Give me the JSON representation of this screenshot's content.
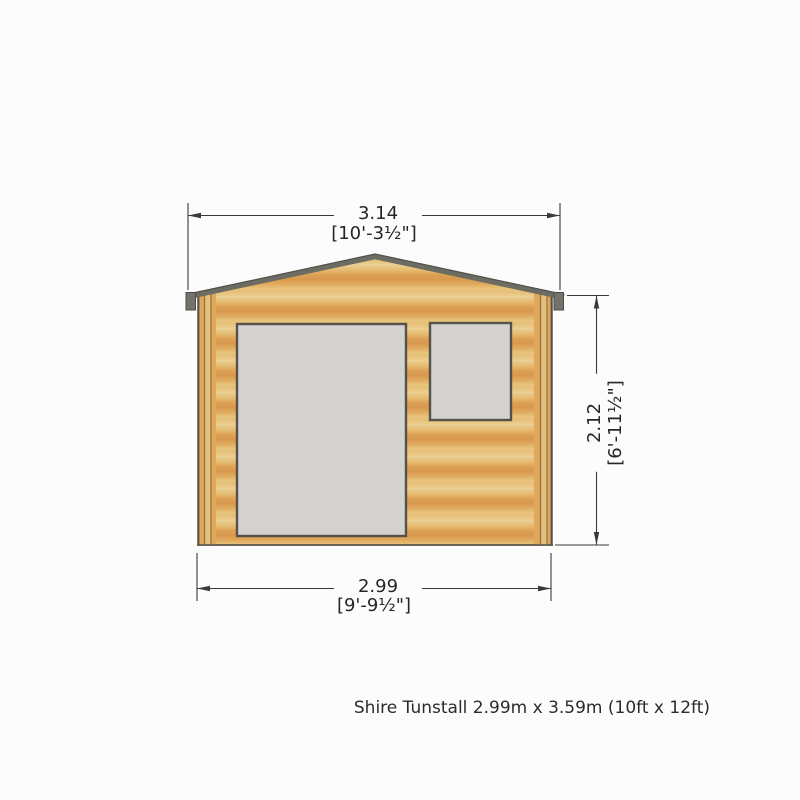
{
  "product": {
    "caption": "Shire Tunstall 2.99m x 3.59m (10ft x 12ft)",
    "name": "Shire Tunstall",
    "size_metric": "2.99m x 3.59m",
    "size_imperial": "(10ft x 12ft)"
  },
  "dimensions": {
    "width_overall": {
      "metric": "3.14",
      "imperial": "[10'-3½\"]"
    },
    "height_eave": {
      "metric": "2.12",
      "imperial": "[6'-11½\"]"
    },
    "width_base": {
      "metric": "2.99",
      "imperial": "[9'-9½\"]"
    }
  },
  "drawing": {
    "view": "front elevation",
    "elements": [
      "gable roof with fascia",
      "log cabin wall",
      "corner posts",
      "door opening",
      "window opening"
    ],
    "colors": {
      "wood_light": "#ead093",
      "wood_mid": "#e6bf76",
      "wood_dark": "#dda156",
      "post_outer": "#dd9f55",
      "post_inner": "#e5c07a",
      "roof_fascia": "#6c6c63",
      "glazing_grey": "#d3d2d0",
      "outline": "#56524a",
      "dimension_line": "#3a3a3a",
      "background": "#fcfcfc"
    }
  }
}
